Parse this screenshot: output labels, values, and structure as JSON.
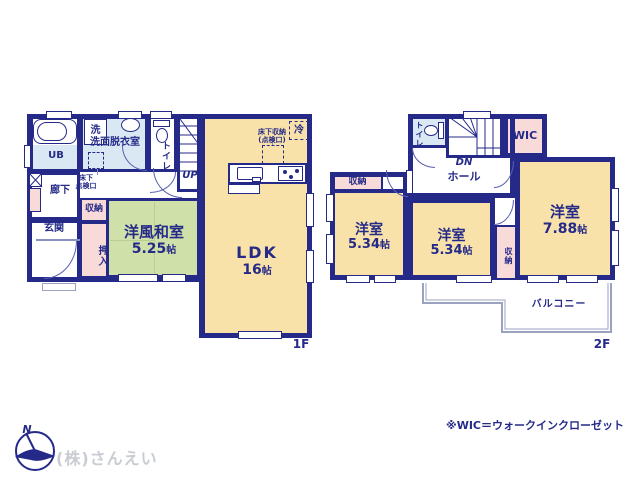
{
  "colors": {
    "wall": "#252a88",
    "ldk_floor": "#f8e2aa",
    "tatami_floor": "#cfe0a8",
    "closet_pink": "#f8dad8",
    "wet_area_blue": "#d9e8f3",
    "balcony_line": "#9aa2c0",
    "company_gray": "#c9ccd3"
  },
  "floor1": {
    "floor_label": "1F",
    "ub": "UB",
    "washroom": "洗面脱衣室",
    "washer": "洗",
    "toilet": "トイレ",
    "up": "UP",
    "corridor": "廊下",
    "entrance": "玄関",
    "closet": "収納",
    "oshiire": "押入",
    "hatch_l1": "床下",
    "hatch_l2": "点検口",
    "jroom": {
      "name": "洋風和室",
      "size": "5.25",
      "unit": "帖"
    },
    "ldk": {
      "name": "LDK",
      "size": "16",
      "unit": "帖"
    },
    "ufs_l1": "床下収納",
    "ufs_l2": "(点検口)",
    "fridge": "冷"
  },
  "floor2": {
    "floor_label": "2F",
    "toilet": "トイレ",
    "dn": "DN",
    "wic": "WIC",
    "hall": "ホール",
    "closet_a": "収納",
    "closet_b": "収納",
    "room_a": {
      "name": "洋室",
      "size": "5.34",
      "unit": "帖"
    },
    "room_b": {
      "name": "洋室",
      "size": "5.34",
      "unit": "帖"
    },
    "room_c": {
      "name": "洋室",
      "size": "7.88",
      "unit": "帖"
    },
    "balcony": "バルコニー"
  },
  "footer": {
    "company": "(株)さんえい",
    "note": "※WIC＝ウォークインクローゼット",
    "north": "N"
  }
}
